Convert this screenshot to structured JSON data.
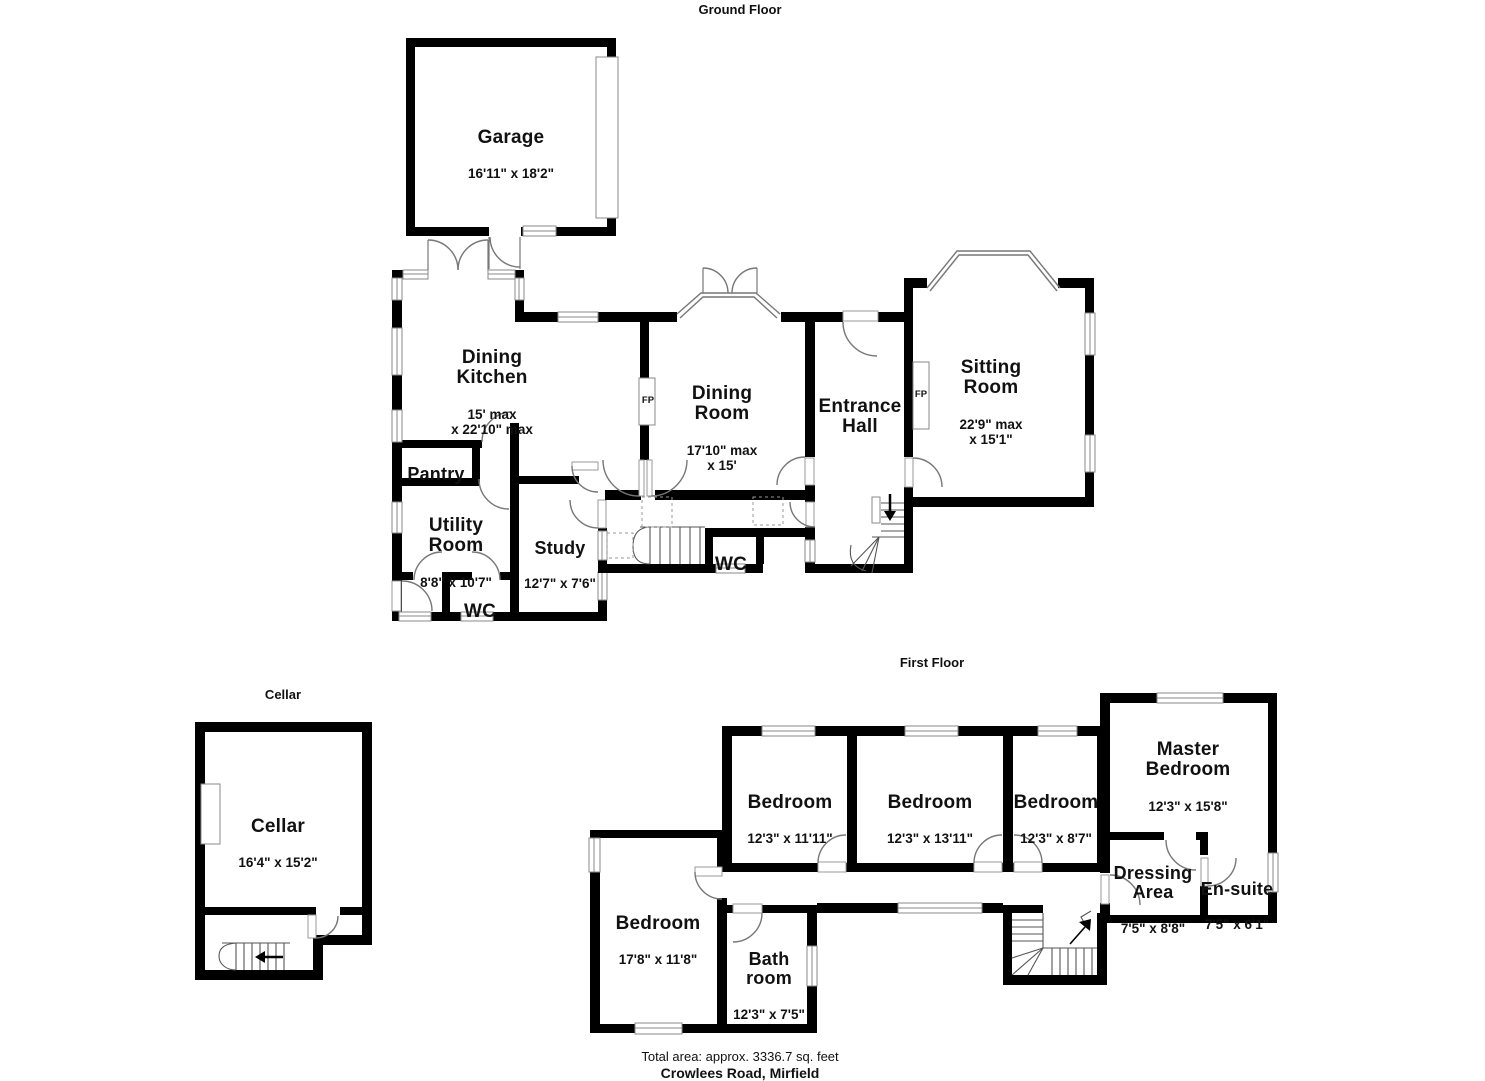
{
  "titles": {
    "ground": "Ground Floor",
    "first": "First Floor",
    "cellar": "Cellar"
  },
  "footer": {
    "total_area": "Total area: approx. 3336.7 sq. feet",
    "address": "Crowlees Road, Mirfield"
  },
  "colors": {
    "wall": "#000000",
    "fixture_gray": "#8a8a8a",
    "text": "#111111"
  },
  "rooms": [
    {
      "floor": "ground",
      "name": "Garage",
      "dims": "16'11\" x 18'2\""
    },
    {
      "floor": "ground",
      "name": "Dining\nKitchen",
      "dims": "15' max\nx 22'10\" max"
    },
    {
      "floor": "ground",
      "name": "Pantry",
      "dims": ""
    },
    {
      "floor": "ground",
      "name": "Utility\nRoom",
      "dims": "8'8\" x 10'7\""
    },
    {
      "floor": "ground",
      "name": "Study",
      "dims": "12'7\" x 7'6\""
    },
    {
      "floor": "ground",
      "name": "WC",
      "dims": ""
    },
    {
      "floor": "ground",
      "name": "WC",
      "dims": ""
    },
    {
      "floor": "ground",
      "name": "Dining\nRoom",
      "dims": "17'10\" max\nx 15'"
    },
    {
      "floor": "ground",
      "name": "Entrance\nHall",
      "dims": ""
    },
    {
      "floor": "ground",
      "name": "Sitting\nRoom",
      "dims": "22'9\" max\nx 15'1\""
    },
    {
      "floor": "cellar",
      "name": "Cellar",
      "dims": "16'4\" x 15'2\""
    },
    {
      "floor": "first",
      "name": "Bedroom",
      "dims": "12'3\" x 11'11\""
    },
    {
      "floor": "first",
      "name": "Bedroom",
      "dims": "12'3\" x 13'11\""
    },
    {
      "floor": "first",
      "name": "Bedroom",
      "dims": "12'3\" x 8'7\""
    },
    {
      "floor": "first",
      "name": "Master\nBedroom",
      "dims": "12'3\" x 15'8\""
    },
    {
      "floor": "first",
      "name": "Dressing\nArea",
      "dims": "7'5\" x 8'8\""
    },
    {
      "floor": "first",
      "name": "En-suite",
      "dims": "7'5\" x 6'1\""
    },
    {
      "floor": "first",
      "name": "Bedroom",
      "dims": "17'8\" x 11'8\""
    },
    {
      "floor": "first",
      "name": "Bath\nroom",
      "dims": "12'3\" x 7'5\""
    }
  ],
  "fireplaces": [
    {
      "label": "FP"
    },
    {
      "label": "FP"
    }
  ]
}
